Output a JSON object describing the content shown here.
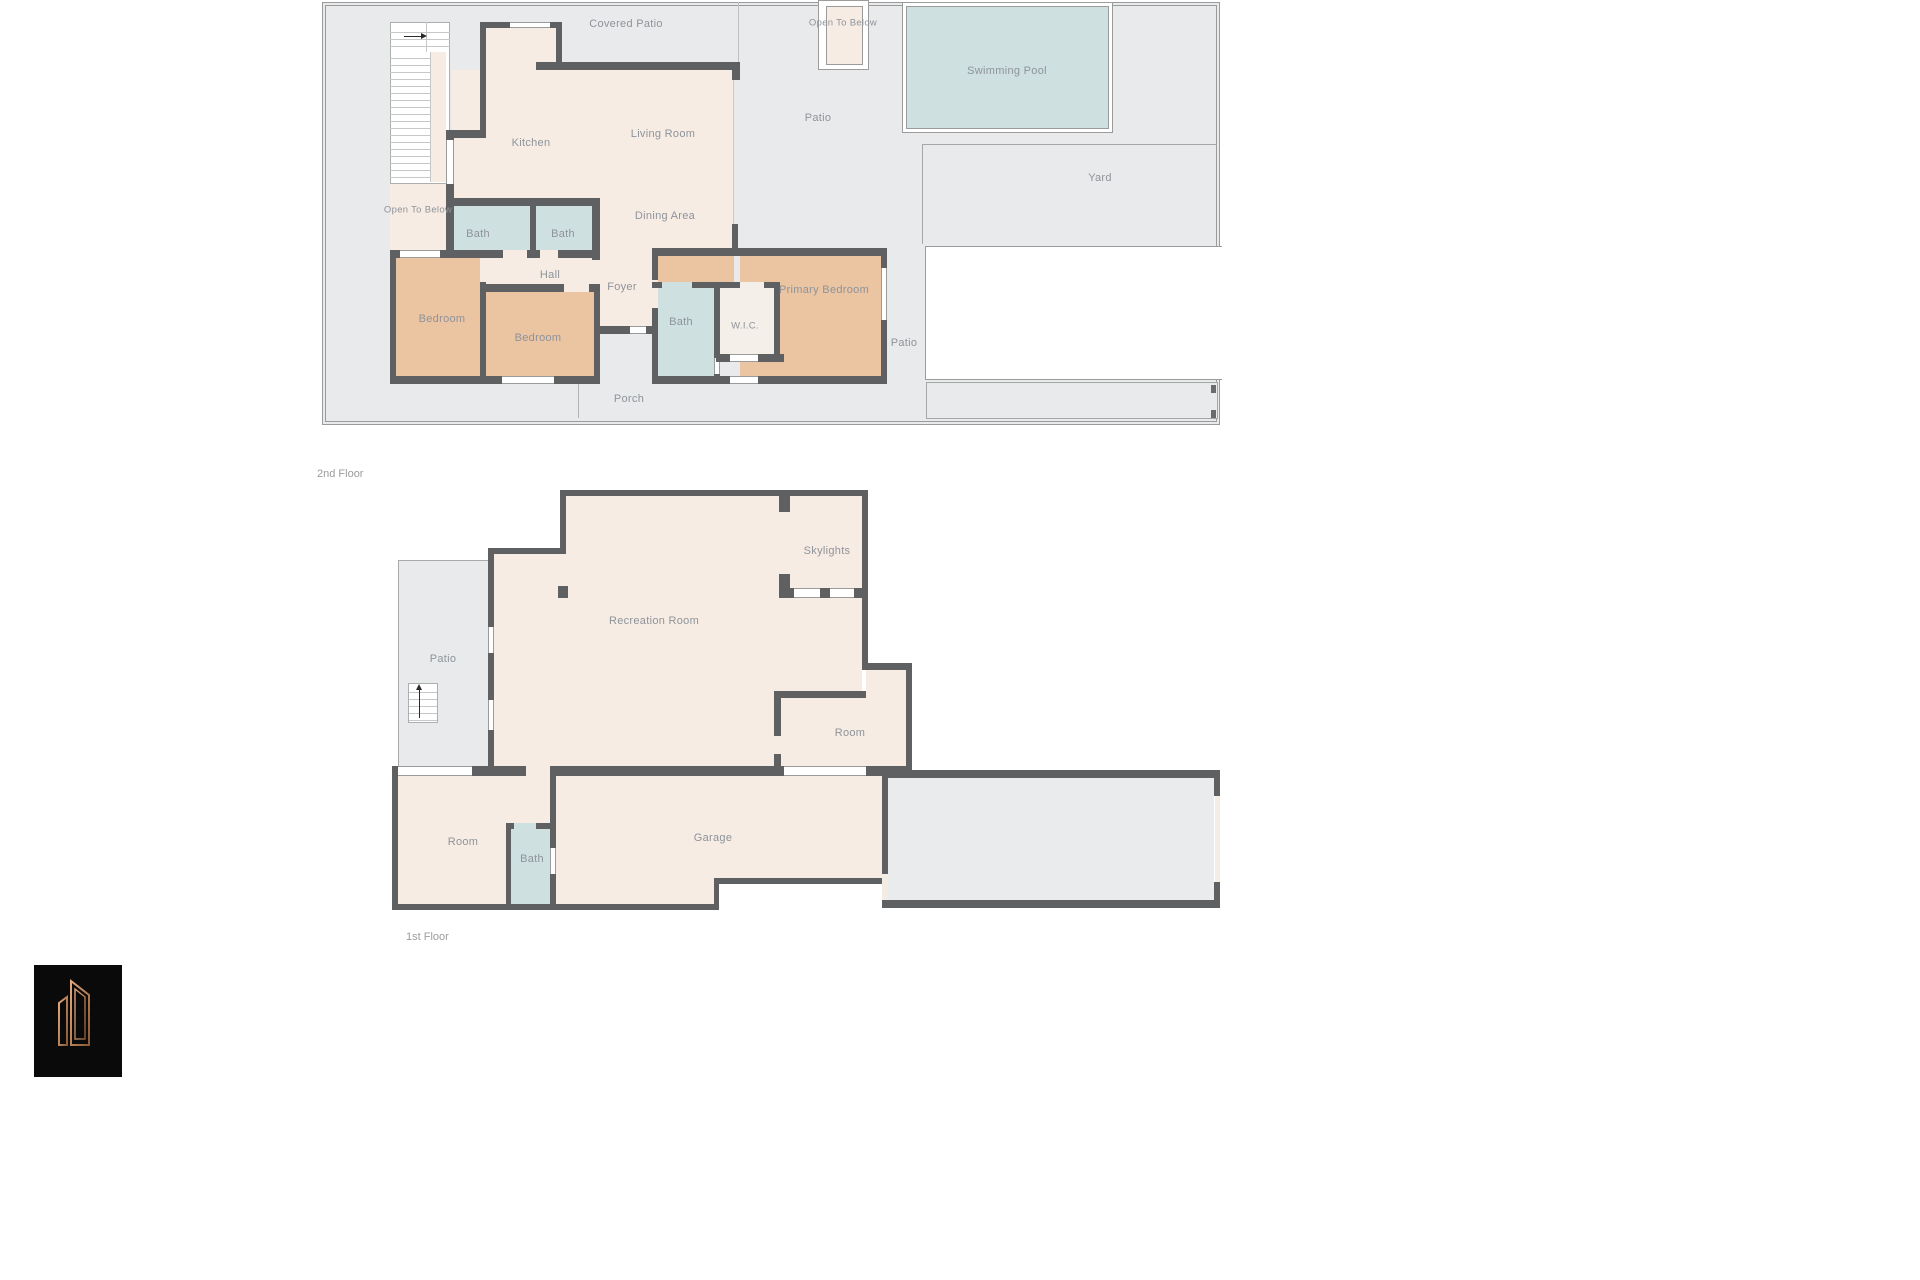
{
  "document": {
    "type": "floor-plan-sheet",
    "background": "#ffffff"
  },
  "colors": {
    "wall": "#5f6061",
    "outdoor_gray": "#e9eaeb",
    "room_cream": "#f6ece4",
    "bedroom_tan": "#ebc4a2",
    "bath_blue": "#cfe0e1",
    "closet_white": "#f5efe9",
    "boundary_line": "#9b9b9c",
    "label_gray": "#8e939a",
    "logo_black": "#0a0a0a",
    "logo_copper": "#c08softwarelol"
  },
  "floor2": {
    "name": "2nd Floor",
    "labels": {
      "covered_patio": "Covered Patio",
      "open_to_below_top": "Open To Below",
      "swimming_pool": "Swimming Pool",
      "patio_top": "Patio",
      "yard": "Yard",
      "kitchen": "Kitchen",
      "living_room": "Living Room",
      "dining_area": "Dining Area",
      "open_to_below_left": "Open To Below",
      "bath_left": "Bath",
      "bath_mid": "Bath",
      "hall": "Hall",
      "foyer": "Foyer",
      "bedroom_left": "Bedroom",
      "bedroom_mid": "Bedroom",
      "primary_bedroom": "Primary Bedroom",
      "bath_suite": "Bath",
      "wic": "W.I.C.",
      "patio_right": "Patio",
      "porch": "Porch"
    }
  },
  "floor1": {
    "name": "1st Floor",
    "labels": {
      "patio": "Patio",
      "recreation_room": "Recreation Room",
      "skylights": "Skylights",
      "room_se": "Room",
      "room_sw": "Room",
      "bath": "Bath",
      "garage": "Garage"
    }
  },
  "logo": {
    "name": "builder-logo"
  }
}
